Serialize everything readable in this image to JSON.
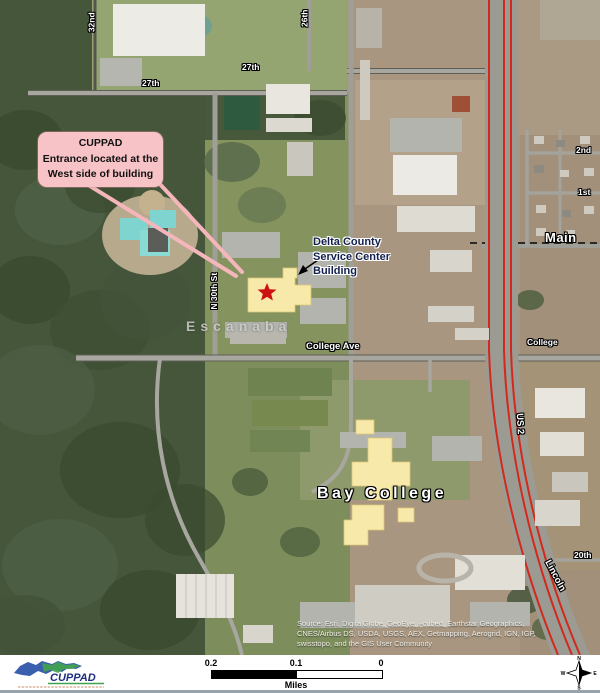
{
  "map": {
    "callout": {
      "title": "CUPPAD",
      "line1": "Entrance located at the",
      "line2": "West side of building"
    },
    "service_center_label": {
      "line1": "Delta County",
      "line2": "Service Center",
      "line3": "Building"
    },
    "city_label": "Escanaba",
    "campus_label": "Bay College",
    "road_labels": {
      "r32nd": "32nd",
      "r26th": "26th",
      "r27th_w": "27th",
      "r27th_e": "27th",
      "n30th": "N 30th St",
      "r2nd": "2nd",
      "r1st": "1st",
      "main": "Main",
      "college_ave": "College Ave",
      "college": "College",
      "us2": "US 2",
      "lincoln": "Lincoln",
      "r20th": "20th"
    },
    "source_lines": {
      "l1": "Source: Esri, DigitalGlobe, GeoEye, i-cubed, Earthstar Geographics,",
      "l2": "CNES/Airbus DS, USDA, USGS, AEX, Getmapping, Aerogrid, IGN, IGP,",
      "l3": "swisstopo, and the GIS User Community"
    }
  },
  "footer": {
    "logo_text": "CUPPAD",
    "scale": {
      "label_left": "0.2",
      "label_mid": "0.1",
      "label_right": "0",
      "unit": "Miles"
    },
    "compass": {
      "n": "N",
      "s": "S",
      "e": "E",
      "w": "W"
    }
  },
  "colors": {
    "callout_pink": "#f8c3c7",
    "highlight_yellow": "#f6e9a9",
    "star_red": "#cc1212",
    "highway_red": "#d2291c",
    "label_navy": "#12204e"
  }
}
